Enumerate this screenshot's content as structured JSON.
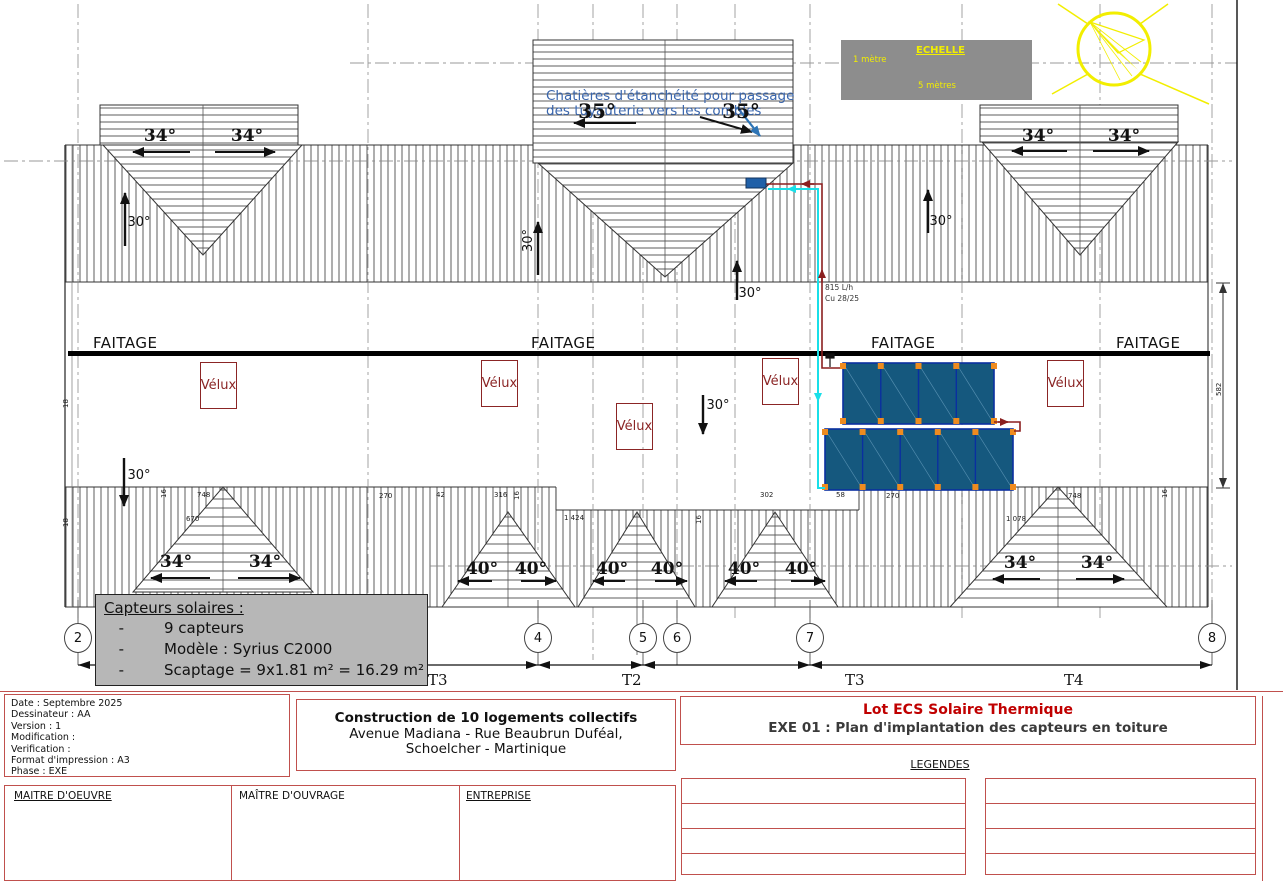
{
  "colors": {
    "sheet_red": "#c0504d",
    "lot_red": "#c00000",
    "panel_blue": "#15587e",
    "pipe_cyan": "#19dfe8",
    "pipe_red": "#8b1f1f",
    "scale_yellow": "#f2ee00",
    "velux_red": "#8b2525",
    "note_blue": "#3a66ad"
  },
  "plan": {
    "faitage": "FAITAGE",
    "velux": "Vélux",
    "deg30": "30°",
    "deg34": "34°",
    "deg35": "35°",
    "deg40": "40°",
    "note_line1": "Chatières d'étanchéité pour passage",
    "note_line2": "des tuyauterie vers les combles",
    "flow_rate": "815 L/h",
    "pipe_size": "Cu 28/25",
    "dims": {
      "d748": "748",
      "d670": "670",
      "d270": "270",
      "d42": "42",
      "d316": "316",
      "d1424": "1 424",
      "d302": "302",
      "d58": "58",
      "d1078": "1 078",
      "d582": "582",
      "d16": "16",
      "d18": "18"
    },
    "bubbles": [
      "2",
      "4",
      "5",
      "6",
      "7",
      "8"
    ],
    "spans": [
      "T3",
      "T2",
      "T3",
      "T4"
    ]
  },
  "scale_box": {
    "title": "ECHELLE",
    "small_label": "1 mètre",
    "large_label": "5 mètres"
  },
  "capteurs_box": {
    "title": "Capteurs solaires :",
    "dash": "-",
    "items": [
      "9 capteurs",
      "Modèle : Syrius C2000",
      "Scaptage = 9x1.81 m² = 16.29 m²"
    ]
  },
  "title_block": {
    "info": [
      "Date : Septembre 2025",
      "Dessinateur : AA",
      "Version : 1",
      "Modification :",
      "Verification :",
      "Format d'impression : A3",
      "Phase : EXE"
    ],
    "project": {
      "line1": "Construction de 10 logements collectifs",
      "line2": "Avenue Madiana - Rue Beaubrun Duféal,",
      "line3": "Schoelcher - Martinique"
    },
    "lot_title": "Lot ECS Solaire Thermique",
    "drawing_title": "EXE 01 : Plan d'implantation des capteurs en toiture",
    "legendes_label": "LEGENDES",
    "roles": [
      "MAITRE D'OEUVRE",
      "MAÎTRE D'OUVRAGE",
      "ENTREPRISE"
    ]
  }
}
